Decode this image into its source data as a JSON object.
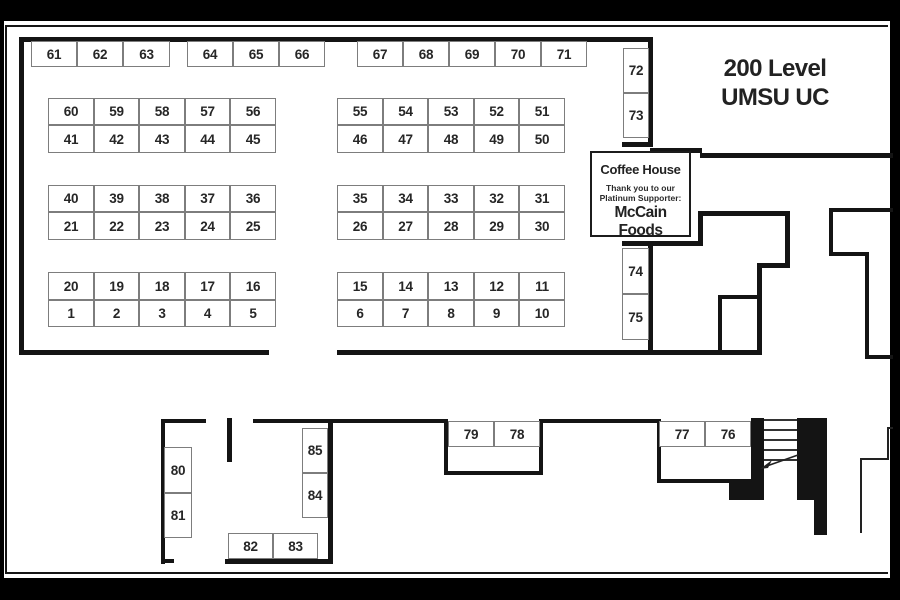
{
  "page": {
    "title_line1": "200 Level",
    "title_line2": "UMSU UC"
  },
  "coffee_house": {
    "name": "Coffee House",
    "thanks_line1": "Thank you to our",
    "thanks_line2": "Platinum Supporter:",
    "sponsor": "McCain Foods"
  },
  "colors": {
    "page_background": "#000000",
    "paper": "#ffffff",
    "wall": "#141414",
    "booth_border": "#7d7d7d",
    "text": "#262626"
  },
  "booths": [
    {
      "label": "61",
      "x": 31,
      "y": 41,
      "w": 46,
      "h": 26
    },
    {
      "label": "62",
      "x": 77,
      "y": 41,
      "w": 46,
      "h": 26
    },
    {
      "label": "63",
      "x": 123,
      "y": 41,
      "w": 47,
      "h": 26
    },
    {
      "label": "64",
      "x": 187,
      "y": 41,
      "w": 46,
      "h": 26
    },
    {
      "label": "65",
      "x": 233,
      "y": 41,
      "w": 46,
      "h": 26
    },
    {
      "label": "66",
      "x": 279,
      "y": 41,
      "w": 46,
      "h": 26
    },
    {
      "label": "67",
      "x": 357,
      "y": 41,
      "w": 46,
      "h": 26
    },
    {
      "label": "68",
      "x": 403,
      "y": 41,
      "w": 46,
      "h": 26
    },
    {
      "label": "69",
      "x": 449,
      "y": 41,
      "w": 46,
      "h": 26
    },
    {
      "label": "70",
      "x": 495,
      "y": 41,
      "w": 46,
      "h": 26
    },
    {
      "label": "71",
      "x": 541,
      "y": 41,
      "w": 46,
      "h": 26
    },
    {
      "label": "60",
      "x": 48,
      "y": 98,
      "w": 46,
      "h": 27
    },
    {
      "label": "59",
      "x": 94,
      "y": 98,
      "w": 45,
      "h": 27
    },
    {
      "label": "58",
      "x": 139,
      "y": 98,
      "w": 46,
      "h": 27
    },
    {
      "label": "57",
      "x": 185,
      "y": 98,
      "w": 45,
      "h": 27
    },
    {
      "label": "56",
      "x": 230,
      "y": 98,
      "w": 46,
      "h": 27
    },
    {
      "label": "41",
      "x": 48,
      "y": 125,
      "w": 46,
      "h": 28
    },
    {
      "label": "42",
      "x": 94,
      "y": 125,
      "w": 45,
      "h": 28
    },
    {
      "label": "43",
      "x": 139,
      "y": 125,
      "w": 46,
      "h": 28
    },
    {
      "label": "44",
      "x": 185,
      "y": 125,
      "w": 45,
      "h": 28
    },
    {
      "label": "45",
      "x": 230,
      "y": 125,
      "w": 46,
      "h": 28
    },
    {
      "label": "55",
      "x": 337,
      "y": 98,
      "w": 46,
      "h": 27
    },
    {
      "label": "54",
      "x": 383,
      "y": 98,
      "w": 45,
      "h": 27
    },
    {
      "label": "53",
      "x": 428,
      "y": 98,
      "w": 46,
      "h": 27
    },
    {
      "label": "52",
      "x": 474,
      "y": 98,
      "w": 45,
      "h": 27
    },
    {
      "label": "51",
      "x": 519,
      "y": 98,
      "w": 46,
      "h": 27
    },
    {
      "label": "46",
      "x": 337,
      "y": 125,
      "w": 46,
      "h": 28
    },
    {
      "label": "47",
      "x": 383,
      "y": 125,
      "w": 45,
      "h": 28
    },
    {
      "label": "48",
      "x": 428,
      "y": 125,
      "w": 46,
      "h": 28
    },
    {
      "label": "49",
      "x": 474,
      "y": 125,
      "w": 45,
      "h": 28
    },
    {
      "label": "50",
      "x": 519,
      "y": 125,
      "w": 46,
      "h": 28
    },
    {
      "label": "40",
      "x": 48,
      "y": 185,
      "w": 46,
      "h": 27
    },
    {
      "label": "39",
      "x": 94,
      "y": 185,
      "w": 45,
      "h": 27
    },
    {
      "label": "38",
      "x": 139,
      "y": 185,
      "w": 46,
      "h": 27
    },
    {
      "label": "37",
      "x": 185,
      "y": 185,
      "w": 45,
      "h": 27
    },
    {
      "label": "36",
      "x": 230,
      "y": 185,
      "w": 46,
      "h": 27
    },
    {
      "label": "21",
      "x": 48,
      "y": 212,
      "w": 46,
      "h": 28
    },
    {
      "label": "22",
      "x": 94,
      "y": 212,
      "w": 45,
      "h": 28
    },
    {
      "label": "23",
      "x": 139,
      "y": 212,
      "w": 46,
      "h": 28
    },
    {
      "label": "24",
      "x": 185,
      "y": 212,
      "w": 45,
      "h": 28
    },
    {
      "label": "25",
      "x": 230,
      "y": 212,
      "w": 46,
      "h": 28
    },
    {
      "label": "35",
      "x": 337,
      "y": 185,
      "w": 46,
      "h": 27
    },
    {
      "label": "34",
      "x": 383,
      "y": 185,
      "w": 45,
      "h": 27
    },
    {
      "label": "33",
      "x": 428,
      "y": 185,
      "w": 46,
      "h": 27
    },
    {
      "label": "32",
      "x": 474,
      "y": 185,
      "w": 45,
      "h": 27
    },
    {
      "label": "31",
      "x": 519,
      "y": 185,
      "w": 46,
      "h": 27
    },
    {
      "label": "26",
      "x": 337,
      "y": 212,
      "w": 46,
      "h": 28
    },
    {
      "label": "27",
      "x": 383,
      "y": 212,
      "w": 45,
      "h": 28
    },
    {
      "label": "28",
      "x": 428,
      "y": 212,
      "w": 46,
      "h": 28
    },
    {
      "label": "29",
      "x": 474,
      "y": 212,
      "w": 45,
      "h": 28
    },
    {
      "label": "30",
      "x": 519,
      "y": 212,
      "w": 46,
      "h": 28
    },
    {
      "label": "20",
      "x": 48,
      "y": 272,
      "w": 46,
      "h": 28
    },
    {
      "label": "19",
      "x": 94,
      "y": 272,
      "w": 45,
      "h": 28
    },
    {
      "label": "18",
      "x": 139,
      "y": 272,
      "w": 46,
      "h": 28
    },
    {
      "label": "17",
      "x": 185,
      "y": 272,
      "w": 45,
      "h": 28
    },
    {
      "label": "16",
      "x": 230,
      "y": 272,
      "w": 46,
      "h": 28
    },
    {
      "label": "1",
      "x": 48,
      "y": 300,
      "w": 46,
      "h": 27
    },
    {
      "label": "2",
      "x": 94,
      "y": 300,
      "w": 45,
      "h": 27
    },
    {
      "label": "3",
      "x": 139,
      "y": 300,
      "w": 46,
      "h": 27
    },
    {
      "label": "4",
      "x": 185,
      "y": 300,
      "w": 45,
      "h": 27
    },
    {
      "label": "5",
      "x": 230,
      "y": 300,
      "w": 46,
      "h": 27
    },
    {
      "label": "15",
      "x": 337,
      "y": 272,
      "w": 46,
      "h": 28
    },
    {
      "label": "14",
      "x": 383,
      "y": 272,
      "w": 45,
      "h": 28
    },
    {
      "label": "13",
      "x": 428,
      "y": 272,
      "w": 46,
      "h": 28
    },
    {
      "label": "12",
      "x": 474,
      "y": 272,
      "w": 45,
      "h": 28
    },
    {
      "label": "11",
      "x": 519,
      "y": 272,
      "w": 46,
      "h": 28
    },
    {
      "label": "6",
      "x": 337,
      "y": 300,
      "w": 46,
      "h": 27
    },
    {
      "label": "7",
      "x": 383,
      "y": 300,
      "w": 45,
      "h": 27
    },
    {
      "label": "8",
      "x": 428,
      "y": 300,
      "w": 46,
      "h": 27
    },
    {
      "label": "9",
      "x": 474,
      "y": 300,
      "w": 45,
      "h": 27
    },
    {
      "label": "10",
      "x": 519,
      "y": 300,
      "w": 46,
      "h": 27
    },
    {
      "label": "72",
      "x": 623,
      "y": 48,
      "w": 26,
      "h": 45
    },
    {
      "label": "73",
      "x": 623,
      "y": 93,
      "w": 26,
      "h": 45
    },
    {
      "label": "74",
      "x": 622,
      "y": 248,
      "w": 27,
      "h": 46
    },
    {
      "label": "75",
      "x": 622,
      "y": 294,
      "w": 27,
      "h": 46
    },
    {
      "label": "76",
      "x": 705,
      "y": 421,
      "w": 46,
      "h": 26
    },
    {
      "label": "77",
      "x": 659,
      "y": 421,
      "w": 46,
      "h": 26
    },
    {
      "label": "78",
      "x": 494,
      "y": 421,
      "w": 46,
      "h": 26
    },
    {
      "label": "79",
      "x": 448,
      "y": 421,
      "w": 46,
      "h": 26
    },
    {
      "label": "80",
      "x": 164,
      "y": 447,
      "w": 28,
      "h": 46
    },
    {
      "label": "81",
      "x": 164,
      "y": 493,
      "w": 28,
      "h": 45
    },
    {
      "label": "82",
      "x": 228,
      "y": 533,
      "w": 45,
      "h": 26
    },
    {
      "label": "83",
      "x": 273,
      "y": 533,
      "w": 45,
      "h": 26
    },
    {
      "label": "84",
      "x": 302,
      "y": 473,
      "w": 26,
      "h": 45
    },
    {
      "label": "85",
      "x": 302,
      "y": 428,
      "w": 26,
      "h": 45
    }
  ],
  "walls": [
    {
      "x": 19,
      "y": 37,
      "w": 633,
      "h": 5
    },
    {
      "x": 19,
      "y": 37,
      "w": 5,
      "h": 318
    },
    {
      "x": 19,
      "y": 350,
      "w": 250,
      "h": 5
    },
    {
      "x": 337,
      "y": 350,
      "w": 425,
      "h": 5
    },
    {
      "x": 648,
      "y": 37,
      "w": 5,
      "h": 110
    },
    {
      "x": 622,
      "y": 142,
      "w": 31,
      "h": 5
    },
    {
      "x": 650,
      "y": 148,
      "w": 52,
      "h": 5
    },
    {
      "x": 700,
      "y": 153,
      "w": 193,
      "h": 5
    },
    {
      "x": 622,
      "y": 241,
      "w": 81,
      "h": 5
    },
    {
      "x": 698,
      "y": 211,
      "w": 5,
      "h": 35
    },
    {
      "x": 698,
      "y": 211,
      "w": 92,
      "h": 5
    },
    {
      "x": 785,
      "y": 211,
      "w": 5,
      "h": 57
    },
    {
      "x": 757,
      "y": 263,
      "w": 33,
      "h": 5
    },
    {
      "x": 757,
      "y": 263,
      "w": 5,
      "h": 92
    },
    {
      "x": 648,
      "y": 241,
      "w": 5,
      "h": 114
    },
    {
      "x": 718,
      "y": 295,
      "w": 44,
      "h": 4
    },
    {
      "x": 718,
      "y": 295,
      "w": 4,
      "h": 60
    },
    {
      "x": 829,
      "y": 208,
      "w": 64,
      "h": 4
    },
    {
      "x": 829,
      "y": 208,
      "w": 4,
      "h": 48
    },
    {
      "x": 829,
      "y": 252,
      "w": 40,
      "h": 4
    },
    {
      "x": 865,
      "y": 252,
      "w": 4,
      "h": 107
    },
    {
      "x": 865,
      "y": 355,
      "w": 28,
      "h": 4
    },
    {
      "x": 161,
      "y": 419,
      "w": 4,
      "h": 145
    },
    {
      "x": 161,
      "y": 419,
      "w": 45,
      "h": 4
    },
    {
      "x": 161,
      "y": 559,
      "w": 13,
      "h": 4
    },
    {
      "x": 227,
      "y": 418,
      "w": 5,
      "h": 44
    },
    {
      "x": 253,
      "y": 419,
      "w": 194,
      "h": 4
    },
    {
      "x": 444,
      "y": 419,
      "w": 4,
      "h": 56
    },
    {
      "x": 444,
      "y": 471,
      "w": 99,
      "h": 4
    },
    {
      "x": 539,
      "y": 419,
      "w": 4,
      "h": 56
    },
    {
      "x": 543,
      "y": 419,
      "w": 118,
      "h": 4
    },
    {
      "x": 657,
      "y": 419,
      "w": 4,
      "h": 64
    },
    {
      "x": 657,
      "y": 479,
      "w": 95,
      "h": 4
    },
    {
      "x": 751,
      "y": 418,
      "w": 13,
      "h": 82
    },
    {
      "x": 729,
      "y": 483,
      "w": 35,
      "h": 17
    },
    {
      "x": 797,
      "y": 418,
      "w": 30,
      "h": 82
    },
    {
      "x": 814,
      "y": 500,
      "w": 13,
      "h": 35
    },
    {
      "x": 328,
      "y": 419,
      "w": 5,
      "h": 143
    },
    {
      "x": 225,
      "y": 559,
      "w": 108,
      "h": 5
    }
  ],
  "thin_walls": [
    {
      "x": 887,
      "y": 427,
      "w": 6,
      "h": 2
    },
    {
      "x": 887,
      "y": 427,
      "w": 2,
      "h": 33
    },
    {
      "x": 860,
      "y": 458,
      "w": 29,
      "h": 2
    },
    {
      "x": 860,
      "y": 458,
      "w": 2,
      "h": 75
    }
  ],
  "stairs": {
    "treads": [
      {
        "x": 764,
        "y": 419,
        "w": 33,
        "h": 2
      },
      {
        "x": 764,
        "y": 429,
        "w": 33,
        "h": 2
      },
      {
        "x": 764,
        "y": 439,
        "w": 33,
        "h": 2
      },
      {
        "x": 764,
        "y": 449,
        "w": 33,
        "h": 2
      },
      {
        "x": 764,
        "y": 459,
        "w": 33,
        "h": 2
      }
    ]
  }
}
